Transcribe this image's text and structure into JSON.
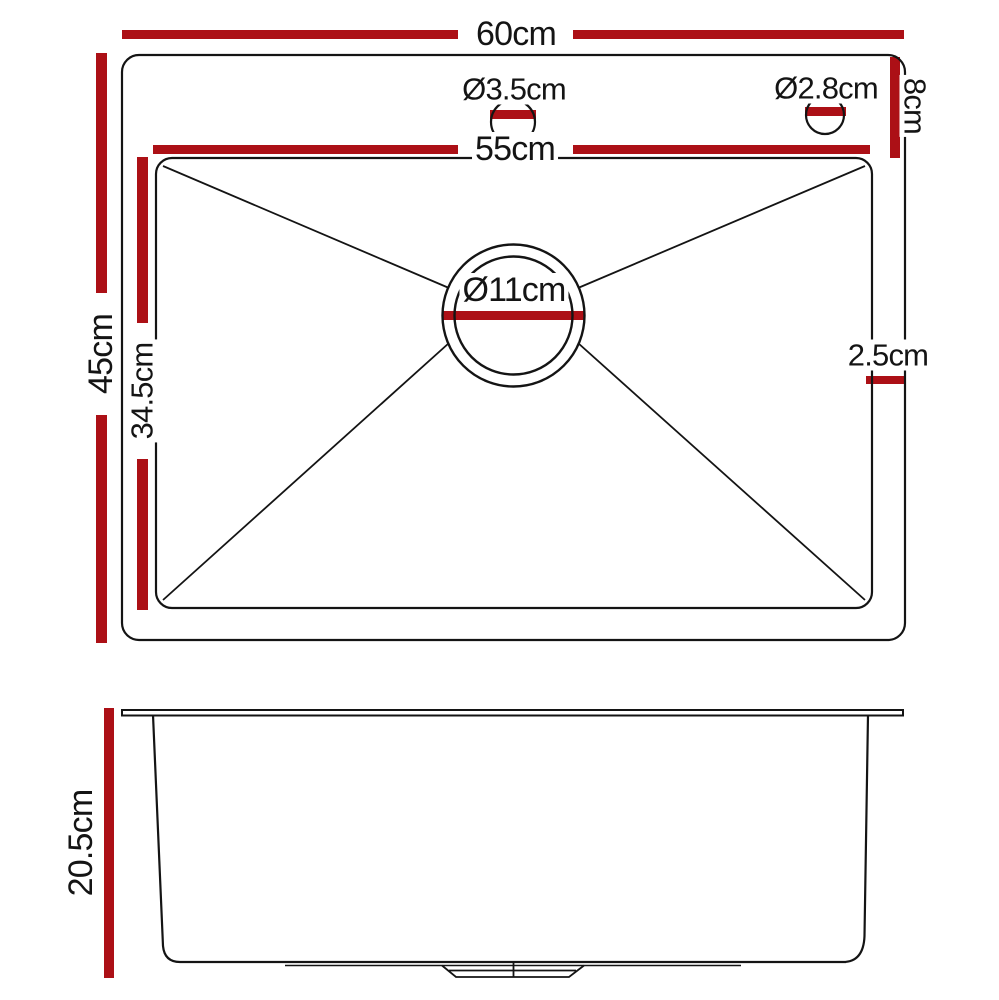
{
  "colors": {
    "accent": "#AC1016",
    "line": "#141414",
    "background": "#ffffff"
  },
  "top_view": {
    "overall_width": "60cm",
    "overall_depth": "45cm",
    "bowl_width": "55cm",
    "bowl_depth": "34.5cm",
    "tap_deck_depth": "8cm",
    "tap_hole_left_diameter": "Ø3.5cm",
    "tap_hole_right_diameter": "Ø2.8cm",
    "drain_diameter": "Ø11cm",
    "side_lip_width": "2.5cm"
  },
  "side_view": {
    "bowl_height": "20.5cm"
  }
}
